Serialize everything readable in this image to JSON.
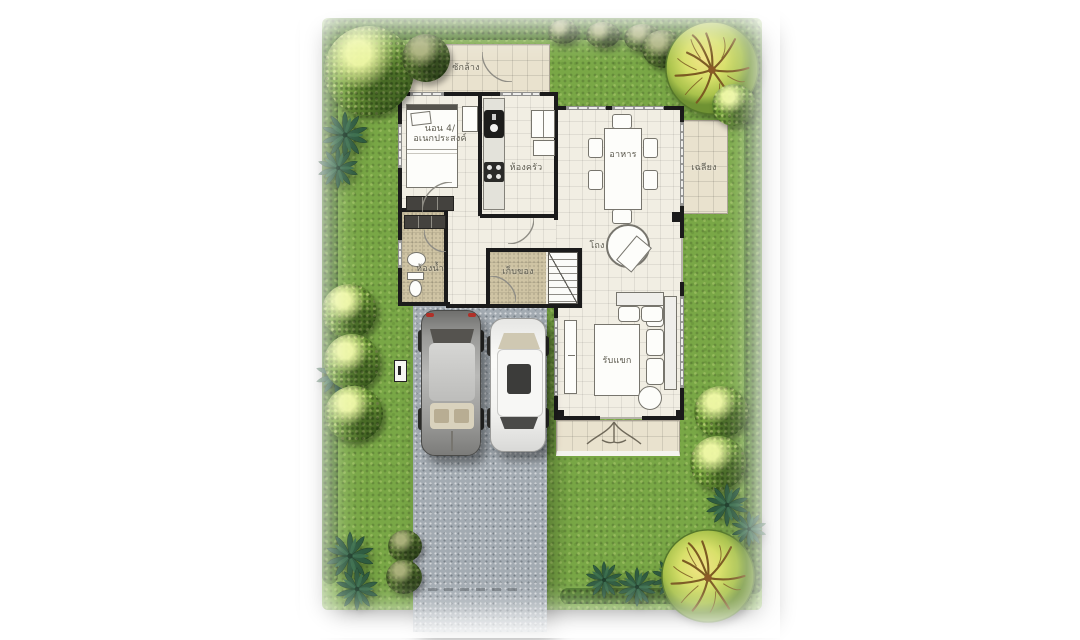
{
  "plan": {
    "title": "single-storey-house-floor-plan-with-garden",
    "rooms": {
      "laundry": "ซักล้าง",
      "bedroom_line1": "นอน 4/",
      "bedroom_line2": "อเนกประสงค์",
      "kitchen": "ห้องครัว",
      "dining": "อาหาร",
      "terrace": "เฉลียง",
      "hall": "โถง",
      "bathroom": "ห้องน้ำ",
      "storage": "เก็บของ",
      "living": "รับแขก"
    },
    "colors": {
      "lawn": "#79a746",
      "hedge": "#4f7a2c",
      "driveway": "#a3abb2",
      "wall": "#1b1b1b",
      "floor": "#f1eee3",
      "tile": "#e9e2ce",
      "tan_floor": "#cfc4a4",
      "tree_green": "#7aa83f",
      "tree_yellow": "#e8df76"
    }
  }
}
